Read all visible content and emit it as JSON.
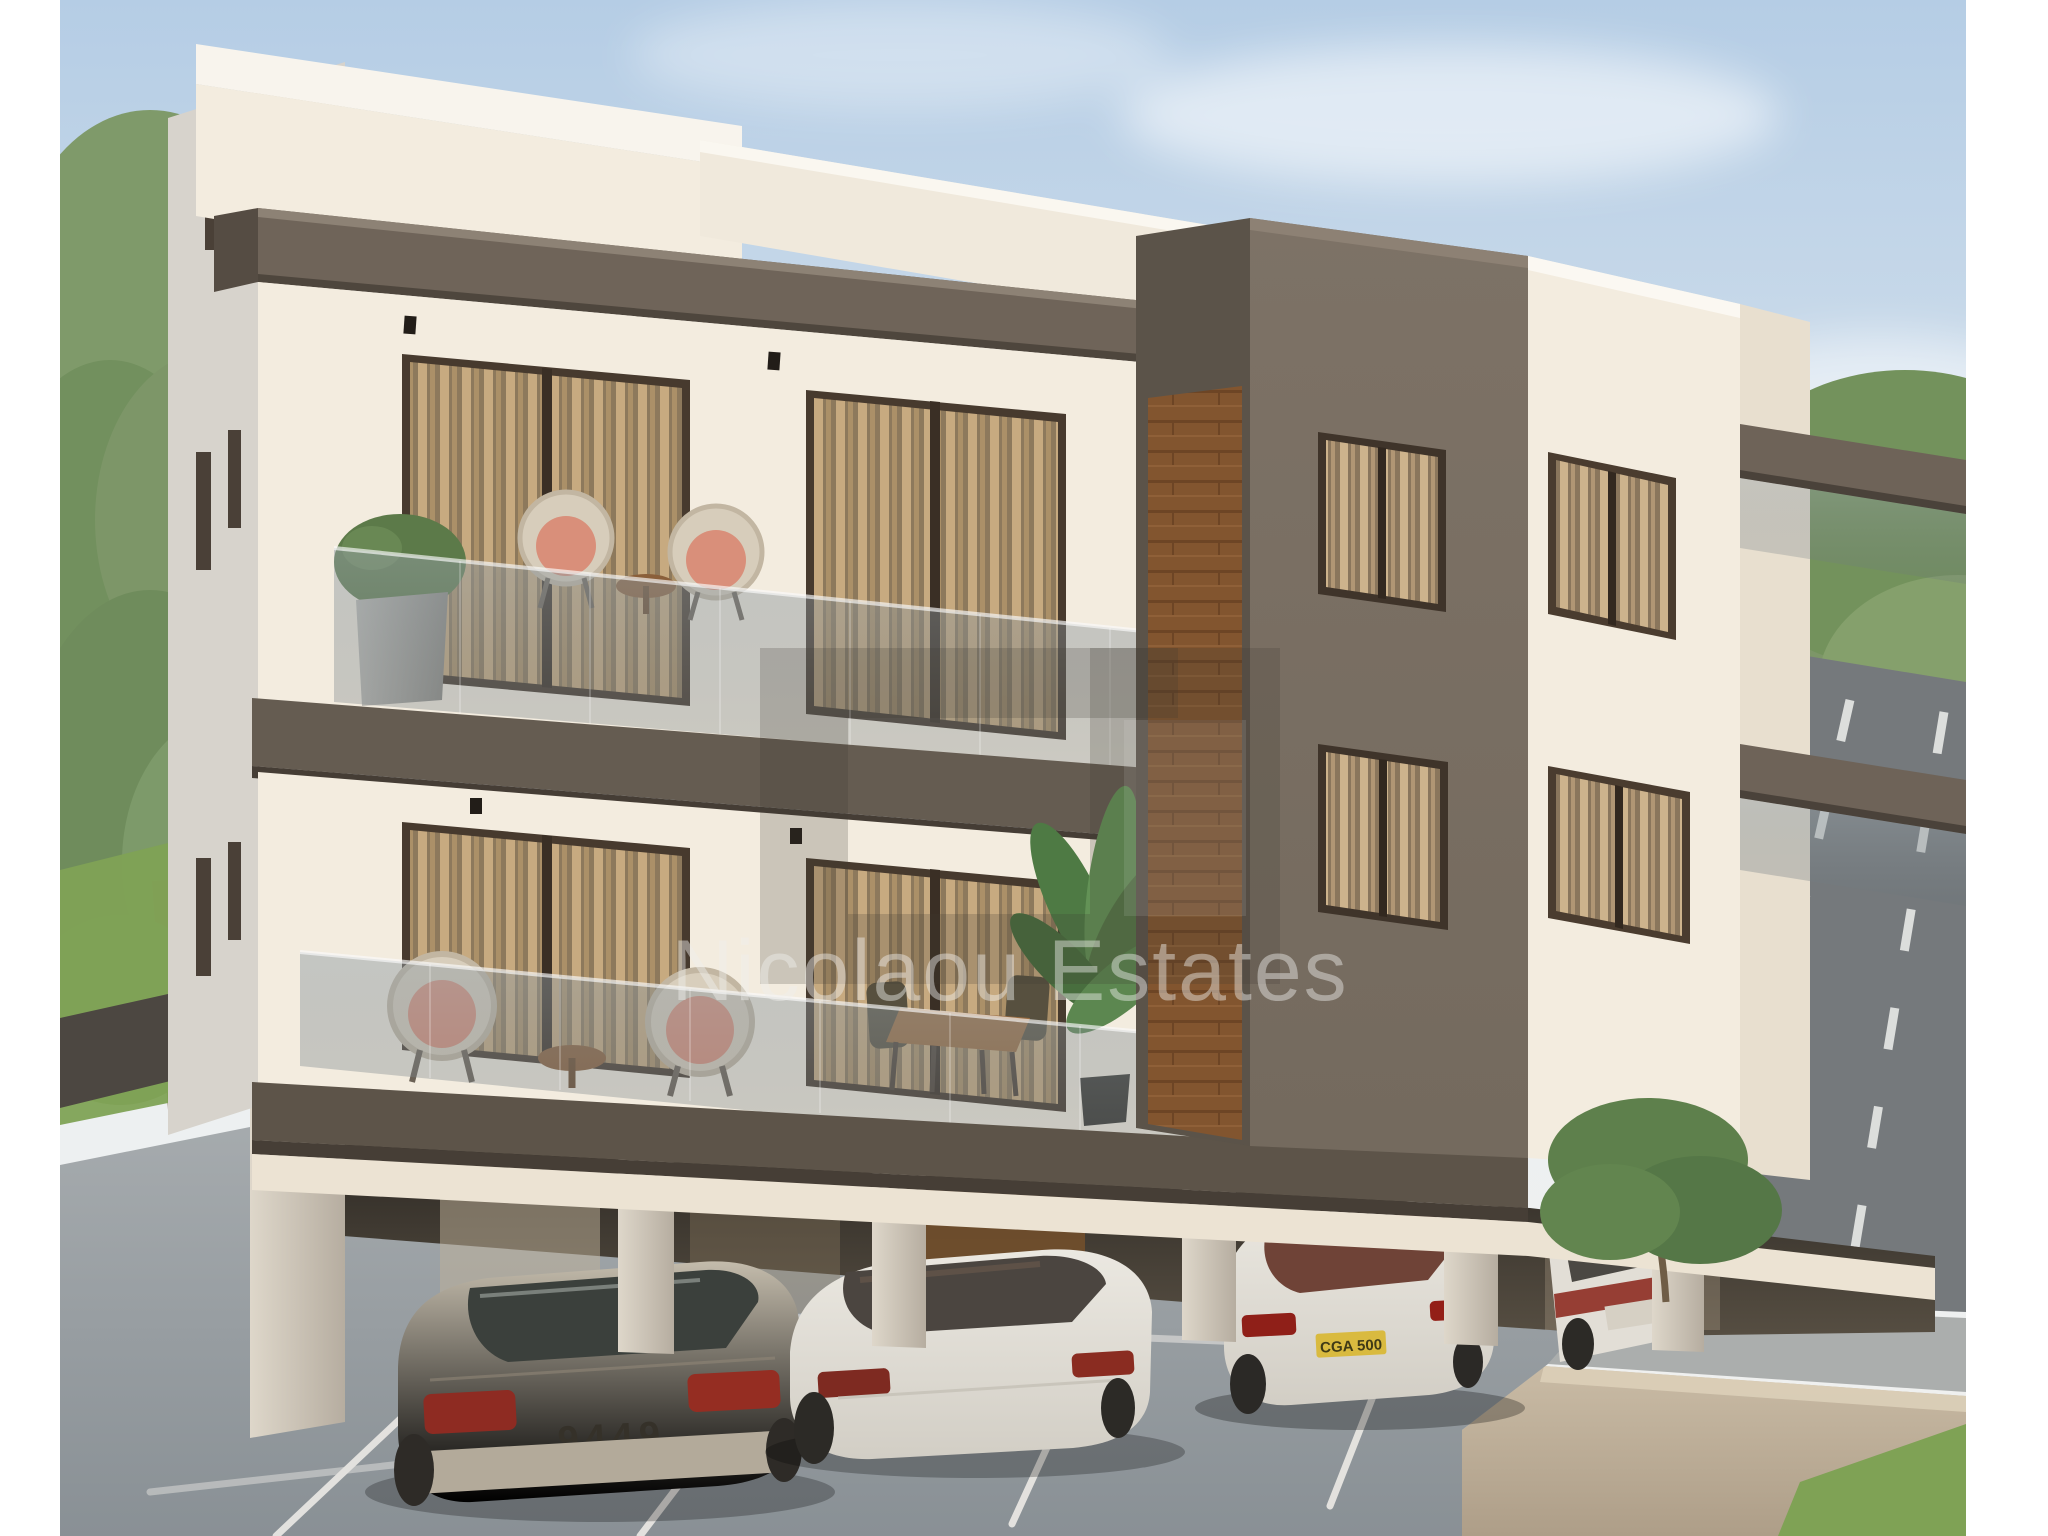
{
  "photo": {
    "watermark_text": "Nicolaou Estates",
    "license_plates": {
      "car_left": "9449",
      "car_bentley": "CGA 500"
    }
  },
  "colors": {
    "sky_top": "#b5cde5",
    "sky_bottom": "#ecf0f2",
    "cream": "#f3ecdf",
    "cream_bright": "#f8f4ed",
    "cream_shade": "#e8dfcf",
    "gray_face": "#d7d3cc",
    "dark_taupe": "#746a5e",
    "fascia": "#6f6459",
    "slab": "#655c51",
    "slab_dark": "#463e36",
    "wood": "#82552f",
    "frame": "#473a2e",
    "curtain": "#c7aa80",
    "glass_tint": "rgba(150,160,166,0.5)",
    "pavement": "#a6abae",
    "road": "#75797c",
    "sidewalk": "#abaead",
    "wall_beige": "#c9bba5",
    "grass": "#7fa255",
    "grass_olive": "#99a354",
    "tree": "#7d9668",
    "garage_dark": "#2c2823",
    "soffit": "#ece3d3",
    "car_champagne": "#c4bcac",
    "car_white": "#ebe8e1",
    "tail_red": "#8e2b22",
    "plate_yellow": "#d9ba3f",
    "watermark_fill": "rgba(240,240,238,0.45)",
    "logo_fill": "rgba(66,59,51,0.22)"
  }
}
